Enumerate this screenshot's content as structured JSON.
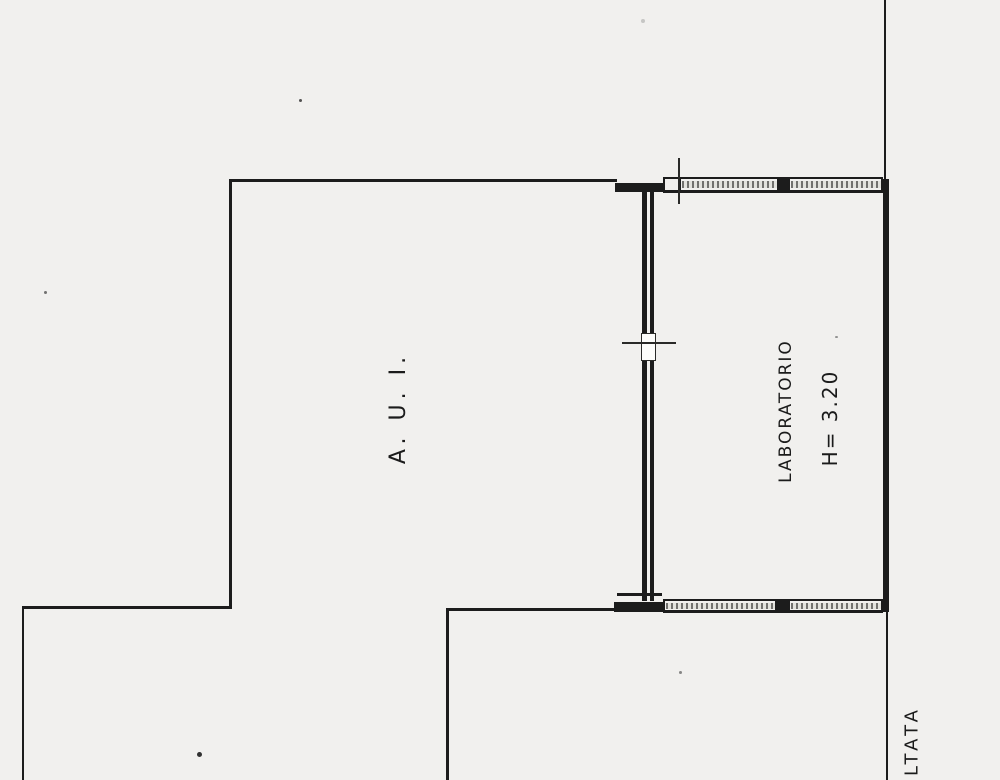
{
  "plan": {
    "rooms": {
      "aui": {
        "label": "A. U. I."
      },
      "laboratorio": {
        "label": "LABORATORIO",
        "height_note": "H= 3.20"
      }
    },
    "annotations": {
      "road_label_partial": "LTATA"
    },
    "colors": {
      "ink": "#1c1c1c",
      "paper": "#f1f0ee",
      "window_stipple_dark": "#2d2d2a",
      "window_stipple_light": "#e1e1db"
    }
  }
}
